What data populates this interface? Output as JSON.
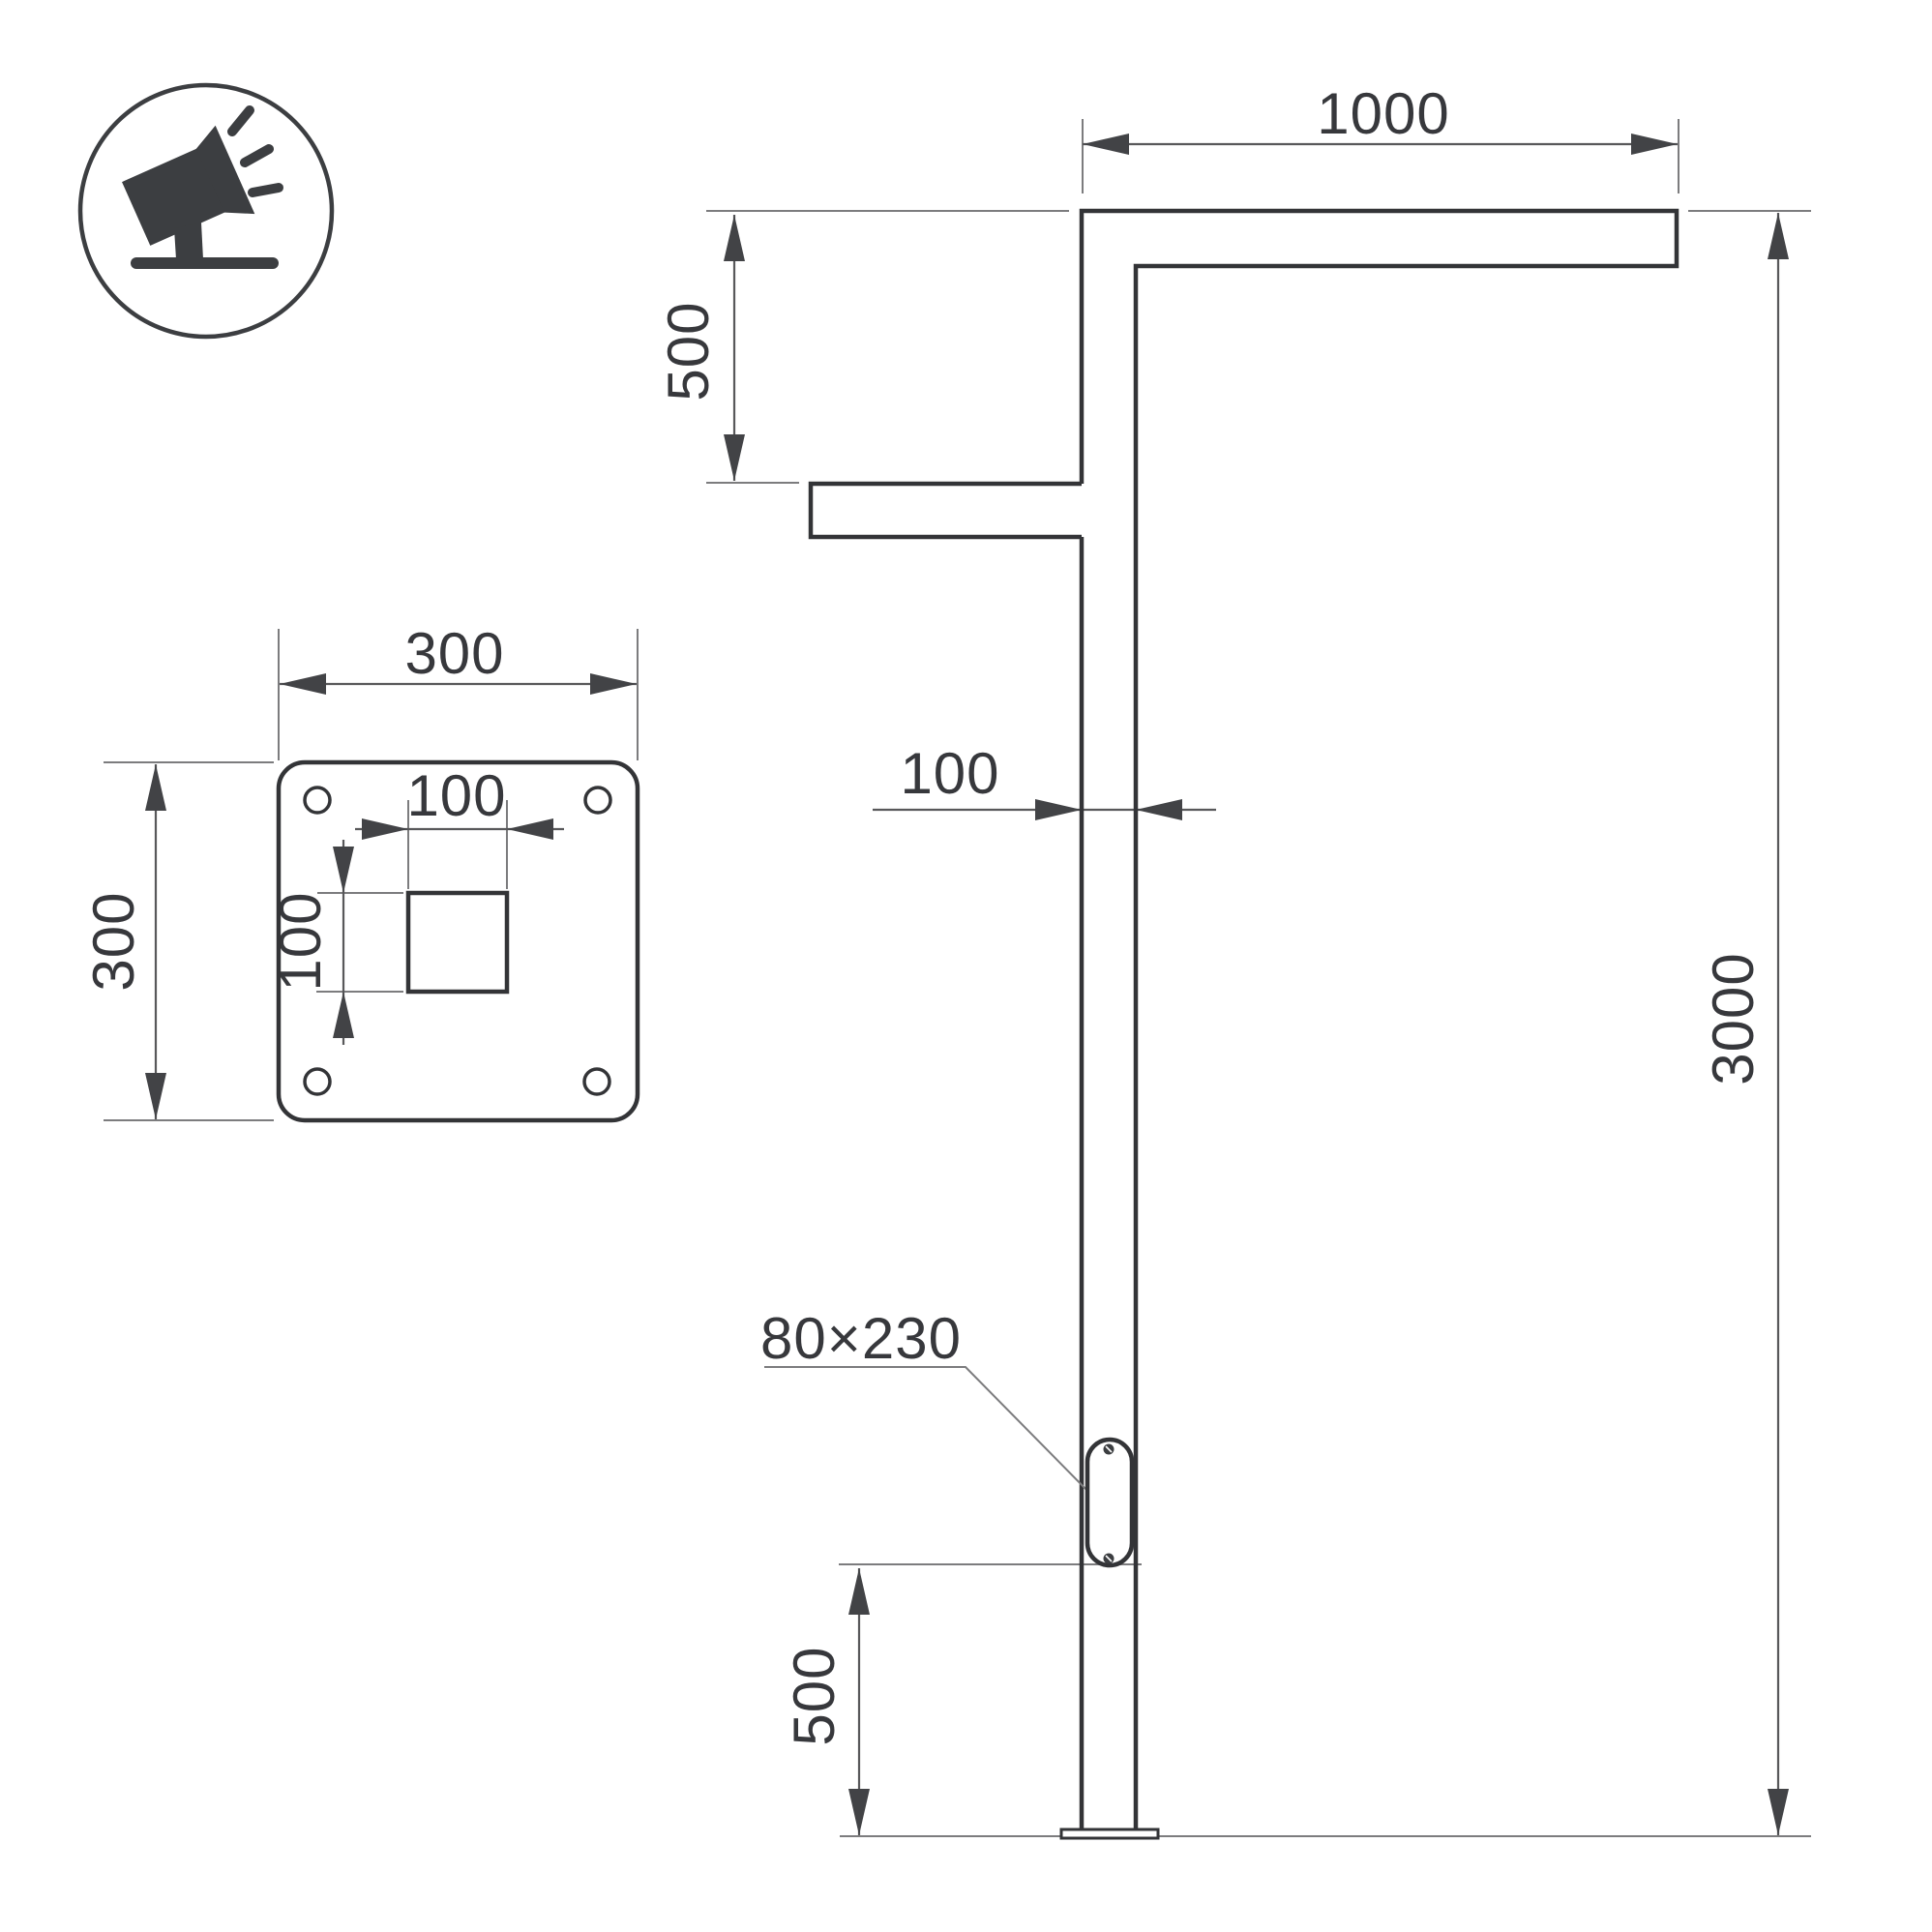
{
  "drawing": {
    "icon": {
      "name": "tilted-floodlight-on-ground"
    },
    "labels": {
      "arm_length": "1000",
      "arm_drop": "500",
      "pole_width": "100",
      "total_height": "3000",
      "door_size": "80×230",
      "door_bottom_height": "500",
      "plate_width": "300",
      "plate_height": "300",
      "cutout_width": "100",
      "cutout_height": "100"
    },
    "colors": {
      "outline": "#333437",
      "dimension_line": "#58585a",
      "thin_line": "#7c7c7e",
      "text": "#37383c",
      "background": "#ffffff"
    }
  }
}
